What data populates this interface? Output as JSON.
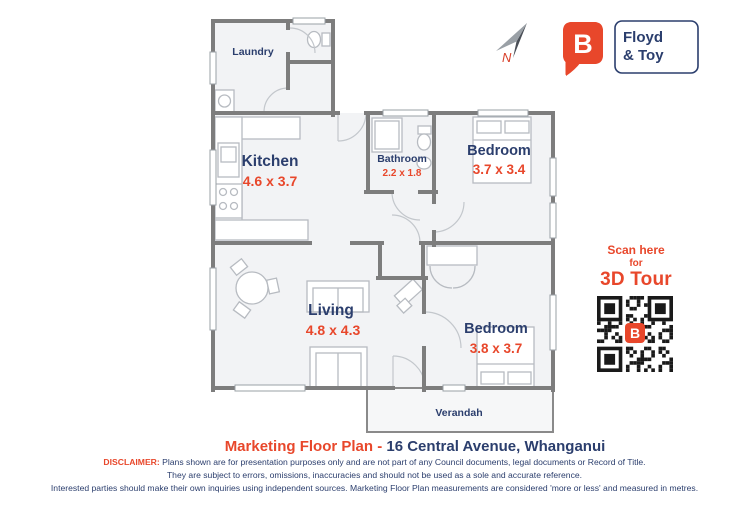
{
  "brand": {
    "logo_letter": "B",
    "name_line1": "Floyd",
    "name_line2": "& Toy",
    "accent_color": "#e8472b",
    "navy_color": "#2b3e6d"
  },
  "compass": {
    "label": "N"
  },
  "floor_plan": {
    "rooms": {
      "laundry": {
        "label": "Laundry"
      },
      "kitchen": {
        "label": "Kitchen",
        "dims": "4.6 x 3.7"
      },
      "bathroom": {
        "label": "Bathroom",
        "dims": "2.2 x 1.8"
      },
      "bedroom1": {
        "label": "Bedroom",
        "dims": "3.7 x 3.4"
      },
      "living": {
        "label": "Living",
        "dims": "4.8 x 4.3"
      },
      "bedroom2": {
        "label": "Bedroom",
        "dims": "3.8 x 3.7"
      },
      "verandah": {
        "label": "Verandah"
      }
    },
    "wall_color": "#7d7d7d",
    "floor_color": "#f2f3f5"
  },
  "qr": {
    "line1": "Scan here",
    "line2": "for",
    "line3": "3D Tour",
    "center_letter": "B"
  },
  "footer": {
    "title_red": "Marketing Floor Plan -",
    "title_navy": "16 Central Avenue, Whanganui",
    "disclaimer_label": "DISCLAIMER:",
    "disclaimer_line1": "Plans shown are for presentation purposes only and are not part of any Council documents, legal documents or Record of Title.",
    "disclaimer_line2": "They are subject to errors, omissions, inaccuracies and should not be used as a sole and accurate reference.",
    "disclaimer_line3": "Interested parties should make their own inquiries using independent sources. Marketing Floor Plan measurements are considered 'more or less' and measured in metres."
  }
}
